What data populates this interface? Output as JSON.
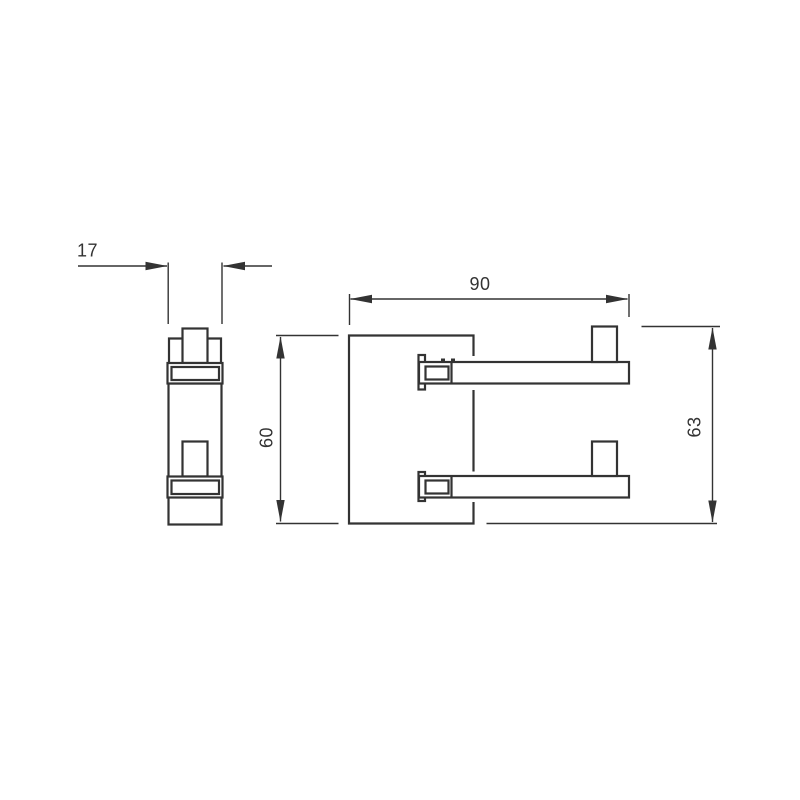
{
  "canvas": {
    "background_color": "#ffffff",
    "line_color": "#333333",
    "text_color": "#333333"
  },
  "drawing": {
    "views": {
      "side_view": {
        "dimension_labels": {
          "depth": "17"
        }
      },
      "front_view": {
        "dimension_labels": {
          "width": "90",
          "plate_height": "60",
          "overall_height": "63"
        }
      }
    }
  }
}
